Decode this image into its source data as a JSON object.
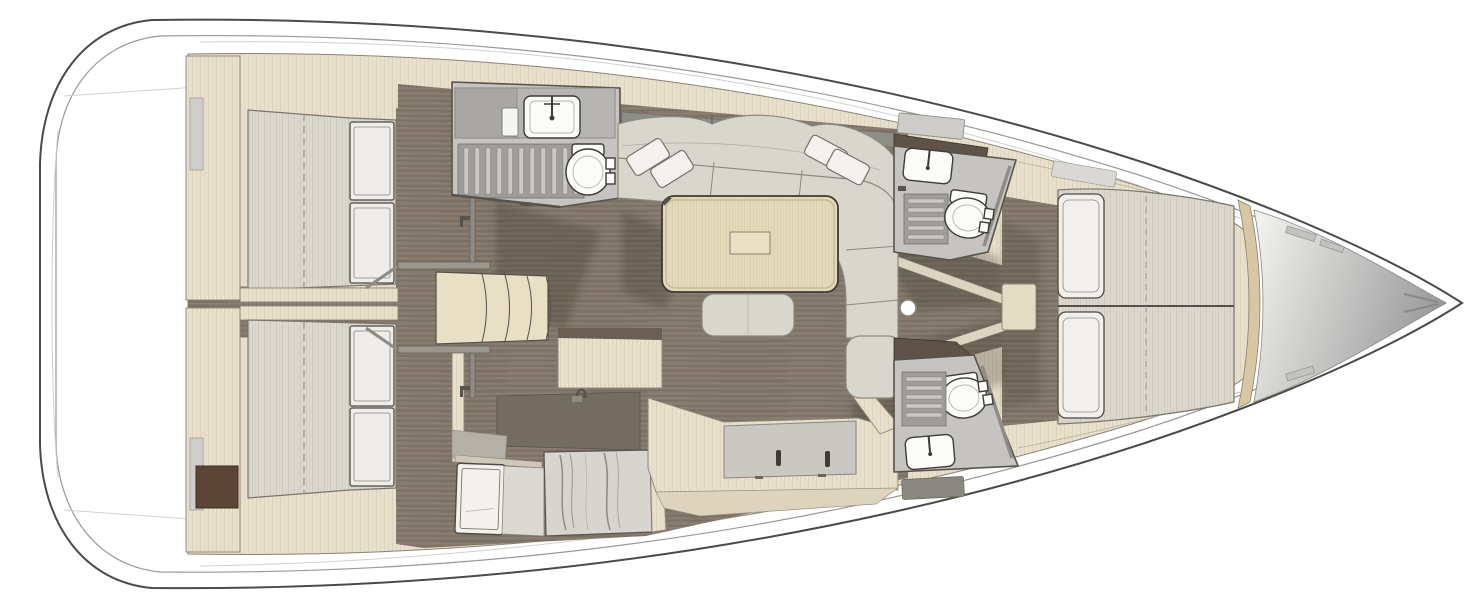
{
  "meta": {
    "title": "sailboat-interior-deck-plan",
    "view": "top-down floor plan, bow pointing right",
    "visible_text": "none"
  },
  "palette": {
    "hull_outline": "#4c4a46",
    "deck_line": "#9a9894",
    "interior_beige": "#e8dfcc",
    "wall_line": "#8a8478",
    "floor_base": "#84796c",
    "head_floor": "#c6c4c1",
    "head_wall": "#57534d",
    "fixture_white": "#fbfbf9",
    "fixture_outline": "#3f3b36",
    "counter_gray": "#b7b5b1",
    "grate_bg": "#9f9d99",
    "grate_slat": "#cbc9c4",
    "cushion": "#d9d6ce",
    "cushion_line": "#8d897f",
    "pillow": "#f3f2ef",
    "table_wood": "#e4d9ba",
    "table_outline": "#3e3a34",
    "mattress": "#dcd8cf",
    "dark_wood": "#5f5248",
    "hatch_brown": "#5a4536",
    "marble": "#d8d5d0",
    "marble_streak": "#6b6560",
    "step_beige": "#e9dfc5",
    "settee_panel": "#cbc8c3",
    "window_strip": "#8e8e88",
    "shadow": "#2e2a24",
    "bow_light": "#f0f0ee",
    "bow_dark": "#98989a",
    "bulkhead_tan": "#d9c6a2"
  },
  "layout": {
    "rooms": [
      {
        "id": "aft-cabin-port",
        "label": "aft double cabin (top-left)",
        "fixtures": [
          "double-berth",
          "two-locker-doors",
          "wardrobe",
          "mirror"
        ]
      },
      {
        "id": "aft-cabin-starboard",
        "label": "aft double cabin (bottom-left)",
        "fixtures": [
          "double-berth",
          "two-locker-doors",
          "wardrobe",
          "mirror",
          "brown-hatch"
        ]
      },
      {
        "id": "aft-head",
        "label": "aft bathroom with shower (top-middle)",
        "fixtures": [
          "sink",
          "faucet",
          "shower-grate",
          "toilet",
          "counter"
        ]
      },
      {
        "id": "companionway",
        "label": "entry steps from cockpit",
        "fixtures": [
          "four-treads",
          "handrails",
          "landing"
        ]
      },
      {
        "id": "salon",
        "label": "main salon",
        "fixtures": [
          "u-shaped-sofa",
          "four-throw-pillows",
          "dining-table",
          "ottoman",
          "window-strip"
        ]
      },
      {
        "id": "galley",
        "label": "galley (bottom-center)",
        "fixtures": [
          "marble-counter",
          "sink-faucet",
          "fridge-door",
          "cabinets"
        ]
      },
      {
        "id": "hull-side-cabinet",
        "label": "starboard side cabinet/settee",
        "fixtures": [
          "recessed-panel",
          "two-slot-handles"
        ]
      },
      {
        "id": "forward-head-port",
        "label": "forward bathroom (top)",
        "fixtures": [
          "sink",
          "toilet",
          "shower-grate",
          "deck-hatch",
          "counter"
        ]
      },
      {
        "id": "forward-head-starboard",
        "label": "forward bathroom (bottom)",
        "fixtures": [
          "sink",
          "toilet",
          "shower-grate",
          "bath-mat"
        ]
      },
      {
        "id": "passageway",
        "label": "corridor between heads",
        "fixtures": [
          "mast-step"
        ]
      },
      {
        "id": "forward-cabin",
        "label": "owner's forward cabin",
        "fixtures": [
          "island-double-berth",
          "two-pillows",
          "step",
          "deck-hatch"
        ]
      },
      {
        "id": "forepeak",
        "label": "bow sail/anchor locker",
        "fixtures": [
          "deck-fittings",
          "bow-cleat"
        ]
      }
    ]
  }
}
